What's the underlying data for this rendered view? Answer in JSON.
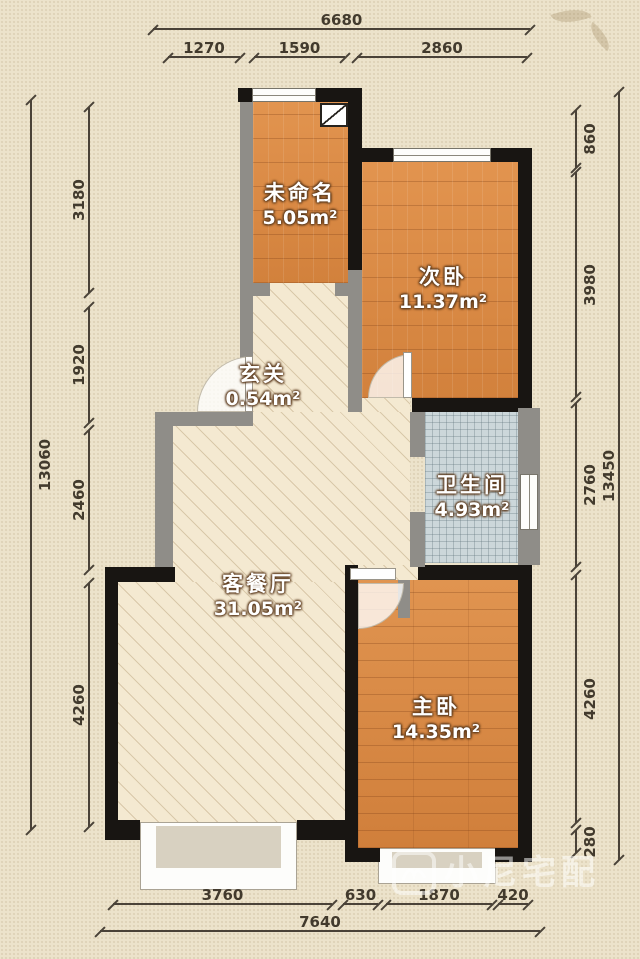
{
  "rooms": [
    {
      "name": "未命名",
      "area": "5.05m²"
    },
    {
      "name": "次卧",
      "area": "11.37m²"
    },
    {
      "name": "玄关",
      "area": "0.54m²"
    },
    {
      "name": "卫生间",
      "area": "4.93m²"
    },
    {
      "name": "客餐厅",
      "area": "31.05m²"
    },
    {
      "name": "主卧",
      "area": "14.35m²"
    }
  ],
  "dimensions": {
    "top": {
      "total": "6680",
      "segments": [
        "1270",
        "1590",
        "2860"
      ]
    },
    "left": {
      "total": "13060",
      "segments": [
        "3180",
        "1920",
        "2460",
        "4260"
      ]
    },
    "right": {
      "total": "13450",
      "segments": [
        "860",
        "3980",
        "2760",
        "4260",
        "280"
      ]
    },
    "bottom": {
      "total": "7640",
      "segments": [
        "3760",
        "630",
        "1870",
        "420"
      ]
    }
  },
  "watermark": {
    "text": "小尼宅配"
  },
  "colors": {
    "paper": "#ece3cb",
    "wood_floor": "#db8e4c",
    "living_floor": "#f4e9d1",
    "tile_floor": "#ccd7da",
    "wall_black": "#181512",
    "wall_gray": "#8f8d88",
    "dimension": "#4a4238"
  }
}
